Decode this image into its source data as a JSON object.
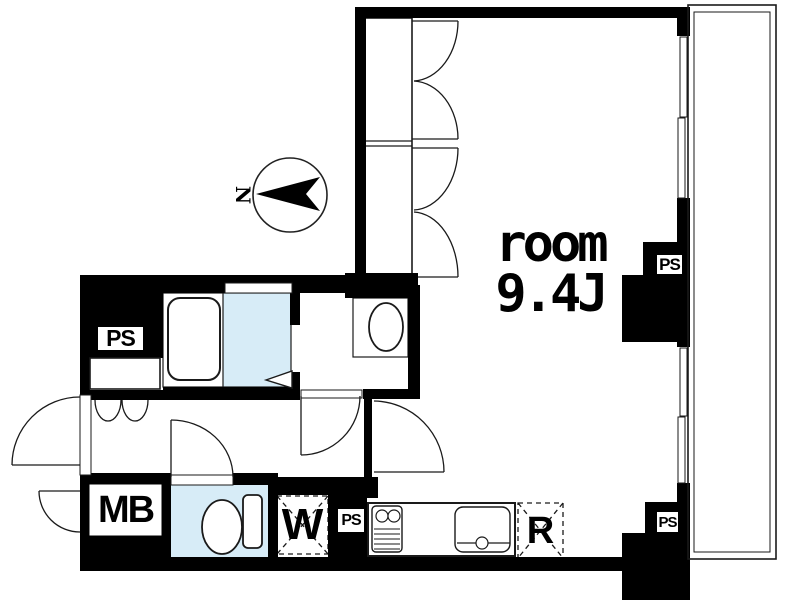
{
  "plan": {
    "room": {
      "label": "room",
      "size": "9.4J"
    },
    "compass": {
      "label": "N"
    },
    "labels": {
      "pipe_space": "PS",
      "meter_box": "MB",
      "washing_machine": "W",
      "refrigerator": "R"
    },
    "colors": {
      "wall": "#000000",
      "wet_area_floor": "#d7ecf7",
      "background": "#ffffff",
      "line": "#1a1a1a"
    }
  }
}
